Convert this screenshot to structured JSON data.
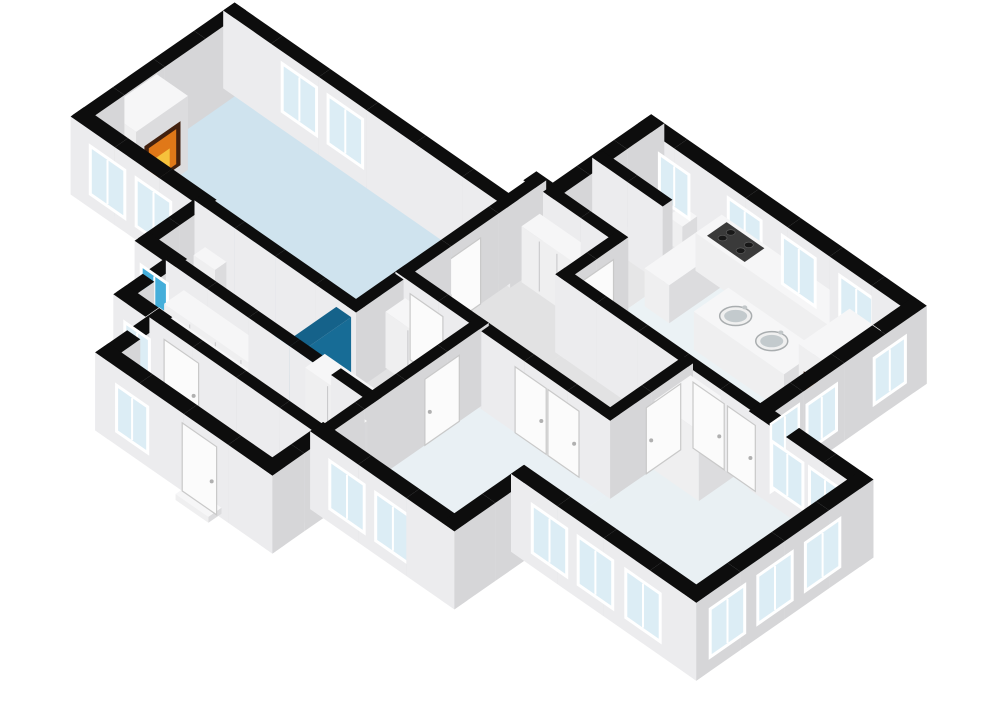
{
  "meta": {
    "view_label": "3d-floorplan-cutaway-render",
    "background": "#ffffff"
  },
  "projection": {
    "ox": 233,
    "oy": 93,
    "ux": 0.82,
    "uy": 0.57,
    "wall_height": 78
  },
  "colors": {
    "cap": "#0d0d0d",
    "faceL": "#ececee",
    "faceR": "#d6d6d8",
    "glass": "#dcedf5",
    "glassBlue": "#45aeda",
    "frame": "#ffffff",
    "doorLeaf": "#fbfbfb",
    "doorEdge": "#c9c9c9",
    "handle": "#b0b0b0",
    "boxTop": "#f6f6f7",
    "boxL": "#efeff0",
    "boxR": "#dcdcde",
    "wardrobeLine": "#c6c6c8",
    "fireDark": "#42210f",
    "fireOrange": "#e07818",
    "fireYellow": "#f6c23c",
    "cooktop": "#3a3a3a",
    "burner": "#181818",
    "burnerRing": "#5c5c5c",
    "stairTop": "#f7f7f7",
    "stairFront": "#e3e3e4",
    "stairSide": "#d8d8da",
    "tubOuter": "#fdfdfd",
    "tubInner": "#edf2f4",
    "tubEdge": "#d5d5d5",
    "metal": "#c2c7c9",
    "sinkRim": "#f0f0f0",
    "sinkBowl": "#c3cacd",
    "sinkEdge": "#a9adaf",
    "showerL": "#2187b7",
    "showerR": "#176c96",
    "showerTop": "#15628a",
    "floorLiving": "#cfe3ee",
    "floorBath": "#2ba3d6",
    "floorHall": "#e2e2e3",
    "floorSmall": "#e6e6e7",
    "floorKitchen": "#ebf2f5",
    "floorBed": "#e9f0f4",
    "floorLounge": "#e9f0f3"
  },
  "floors": [
    {
      "n": "living-room-floor",
      "r": [
        0,
        0,
        330,
        180
      ],
      "fill": "floorLiving"
    },
    {
      "n": "bathroom-floor",
      "r": [
        145,
        180,
        330,
        250
      ],
      "fill": "floorBath"
    },
    {
      "n": "closet-corridor-floor",
      "r": [
        180,
        250,
        420,
        310
      ],
      "fill": "floorHall"
    },
    {
      "n": "entry-hall-floor",
      "r": [
        220,
        310,
        420,
        372
      ],
      "fill": "floorHall"
    },
    {
      "n": "closet-room-floor",
      "r": [
        330,
        120,
        420,
        250
      ],
      "fill": "floorHall"
    },
    {
      "n": "center-hall-floor",
      "r": [
        330,
        -40,
        430,
        120
      ],
      "fill": "floorHall"
    },
    {
      "n": "toilet-room-1-floor",
      "r": [
        350,
        -160,
        430,
        -100
      ],
      "fill": "floorSmall"
    },
    {
      "n": "toilet-room-2-floor",
      "r": [
        350,
        -100,
        430,
        -40
      ],
      "fill": "floorSmall"
    },
    {
      "n": "kitchen-floor",
      "r": [
        430,
        -160,
        670,
        25
      ],
      "fill": "floorKitchen"
    },
    {
      "n": "inner-hall-floor",
      "r": [
        430,
        25,
        580,
        120
      ],
      "fill": "floorHall"
    },
    {
      "n": "bedroom-floor",
      "r": [
        420,
        120,
        580,
        310
      ],
      "fill": "floorBed"
    },
    {
      "n": "living-area-floor",
      "r": [
        580,
        25,
        790,
        225
      ],
      "fill": "floorLounge"
    }
  ],
  "walls": [
    {
      "n": "living-north-wall",
      "r": [
        -10,
        -12,
        340,
        2
      ]
    },
    {
      "n": "living-west-wall",
      "r": [
        -10,
        -12,
        4,
        186
      ]
    },
    {
      "n": "living-southwest-wall",
      "r": [
        -10,
        172,
        152,
        188
      ]
    },
    {
      "n": "bath-west-wall",
      "r": [
        138,
        180,
        152,
        254
      ]
    },
    {
      "n": "bath-south-wall",
      "r": [
        138,
        242,
        186,
        258
      ]
    },
    {
      "n": "corridor-west-wall",
      "r": [
        172,
        250,
        186,
        314
      ]
    },
    {
      "n": "corridor-south-wall",
      "r": [
        172,
        302,
        228,
        318
      ]
    },
    {
      "n": "entry-west-wall",
      "r": [
        212,
        302,
        228,
        380
      ]
    },
    {
      "n": "entry-south-wall",
      "r": [
        212,
        364,
        428,
        380
      ]
    },
    {
      "n": "entry-east-wall",
      "r": [
        412,
        302,
        428,
        380
      ]
    },
    {
      "n": "bedroom-south-wall",
      "r": [
        412,
        302,
        588,
        318
      ]
    },
    {
      "n": "bedroom-east-wall",
      "r": [
        572,
        218,
        588,
        318
      ]
    },
    {
      "n": "lounge-south-wall",
      "r": [
        572,
        217,
        798,
        233
      ]
    },
    {
      "n": "lounge-east-wall",
      "r": [
        782,
        17,
        798,
        233
      ]
    },
    {
      "n": "lounge-north-wall",
      "r": [
        662,
        17,
        798,
        33
      ]
    },
    {
      "n": "kitchen-east-wall",
      "r": [
        662,
        -168,
        678,
        33
      ]
    },
    {
      "n": "kitchen-north-wall",
      "r": [
        422,
        -168,
        678,
        -152
      ]
    },
    {
      "n": "toilet-west-wall",
      "r": [
        342,
        -168,
        358,
        -32
      ]
    },
    {
      "n": "toilet-north-wall",
      "r": [
        342,
        -168,
        430,
        -152
      ]
    },
    {
      "n": "hall-step-wall",
      "r": [
        322,
        -48,
        358,
        -32
      ]
    },
    {
      "n": "living-hall-wall",
      "r": [
        324,
        -46,
        336,
        186
      ]
    },
    {
      "n": "living-bath-wall",
      "r": [
        139,
        174,
        336,
        186
      ]
    },
    {
      "n": "bath-corridor-wall",
      "r": [
        174,
        244,
        426,
        256
      ]
    },
    {
      "n": "corridor-entry-wall",
      "r": [
        214,
        304,
        426,
        316
      ]
    },
    {
      "n": "hall-bedroom-wall",
      "r": [
        324,
        114,
        586,
        126
      ]
    },
    {
      "n": "closet-bedroom-wall",
      "r": [
        414,
        114,
        426,
        316
      ]
    },
    {
      "n": "hall-kitchen-wall",
      "r": [
        424,
        -46,
        436,
        31
      ]
    },
    {
      "n": "kitchen-lounge-wall",
      "r": [
        424,
        19,
        676,
        31
      ]
    },
    {
      "n": "hall-lounge-wall",
      "r": [
        574,
        25,
        586,
        126
      ]
    },
    {
      "n": "toilet-hall-wall",
      "r": [
        344,
        -46,
        436,
        -34
      ]
    },
    {
      "n": "toilet-divider-wall",
      "r": [
        344,
        -106,
        430,
        -94
      ]
    }
  ],
  "openings": [
    {
      "n": "living-north-window-1",
      "k": "win",
      "f": "v",
      "l": 2,
      "r": [
        62,
        104
      ],
      "z": [
        18,
        66
      ]
    },
    {
      "n": "living-north-window-2",
      "k": "win",
      "f": "v",
      "l": 2,
      "r": [
        118,
        160
      ],
      "z": [
        18,
        66
      ]
    },
    {
      "n": "living-sw-window-1",
      "k": "win",
      "f": "v",
      "l": 188,
      "r": [
        14,
        56
      ],
      "z": [
        14,
        62
      ]
    },
    {
      "n": "living-sw-window-2",
      "k": "win",
      "f": "v",
      "l": 188,
      "r": [
        70,
        112
      ],
      "z": [
        14,
        62
      ]
    },
    {
      "n": "bath-window",
      "k": "win",
      "f": "v",
      "l": 258,
      "r": [
        146,
        178
      ],
      "z": [
        14,
        58
      ],
      "g": "glassBlue"
    },
    {
      "n": "corridor-window",
      "k": "win",
      "f": "v",
      "l": 318,
      "r": [
        186,
        216
      ],
      "z": [
        14,
        58
      ]
    },
    {
      "n": "entry-window",
      "k": "win",
      "f": "v",
      "l": 380,
      "r": [
        238,
        276
      ],
      "z": [
        14,
        60
      ]
    },
    {
      "n": "front-door",
      "k": "door",
      "f": "v",
      "l": 380,
      "r": [
        318,
        360
      ],
      "z": [
        0,
        68
      ]
    },
    {
      "n": "bedroom-window-1",
      "k": "win",
      "f": "v",
      "l": 318,
      "r": [
        436,
        478
      ],
      "z": [
        14,
        62
      ]
    },
    {
      "n": "bedroom-window-2",
      "k": "win",
      "f": "v",
      "l": 318,
      "r": [
        492,
        534
      ],
      "z": [
        14,
        62
      ]
    },
    {
      "n": "lounge-south-window-1",
      "k": "win",
      "f": "v",
      "l": 233,
      "r": [
        598,
        640
      ],
      "z": [
        14,
        62
      ]
    },
    {
      "n": "lounge-south-window-2",
      "k": "win",
      "f": "v",
      "l": 233,
      "r": [
        654,
        696
      ],
      "z": [
        14,
        62
      ]
    },
    {
      "n": "lounge-south-window-3",
      "k": "win",
      "f": "v",
      "l": 233,
      "r": [
        712,
        754
      ],
      "z": [
        14,
        62
      ]
    },
    {
      "n": "lounge-east-window-1",
      "k": "win",
      "f": "u",
      "l": 798,
      "r": [
        58,
        100
      ],
      "z": [
        14,
        62
      ]
    },
    {
      "n": "lounge-east-window-2",
      "k": "win",
      "f": "u",
      "l": 798,
      "r": [
        116,
        158
      ],
      "z": [
        14,
        62
      ]
    },
    {
      "n": "lounge-east-window-3",
      "k": "win",
      "f": "u",
      "l": 798,
      "r": [
        174,
        216
      ],
      "z": [
        14,
        62
      ]
    },
    {
      "n": "lounge-north-window-1",
      "k": "win",
      "f": "v",
      "l": 33,
      "r": [
        690,
        728
      ],
      "z": [
        18,
        64
      ]
    },
    {
      "n": "lounge-north-window-2",
      "k": "win",
      "f": "v",
      "l": 33,
      "r": [
        736,
        774
      ],
      "z": [
        18,
        64
      ]
    },
    {
      "n": "kitchen-east-window-1",
      "k": "win",
      "f": "u",
      "l": 678,
      "r": [
        -142,
        -104
      ],
      "z": [
        16,
        62
      ]
    },
    {
      "n": "kitchen-east-window-2",
      "k": "win",
      "f": "u",
      "l": 678,
      "r": [
        -58,
        -22
      ],
      "z": [
        16,
        62
      ]
    },
    {
      "n": "kitchen-glass-door",
      "k": "gdoor",
      "f": "u",
      "l": 678,
      "r": [
        -12,
        22
      ],
      "z": [
        0,
        68
      ]
    },
    {
      "n": "kitchen-north-window-1",
      "k": "win",
      "f": "v",
      "l": -152,
      "r": [
        452,
        492
      ],
      "z": [
        18,
        66
      ]
    },
    {
      "n": "kitchen-north-window-2",
      "k": "win",
      "f": "v",
      "l": -152,
      "r": [
        518,
        558
      ],
      "z": [
        18,
        66
      ]
    },
    {
      "n": "kitchen-north-window-3",
      "k": "win",
      "f": "v",
      "l": -152,
      "r": [
        588,
        628
      ],
      "z": [
        18,
        66
      ]
    },
    {
      "n": "toilet-north-window",
      "k": "win",
      "f": "v",
      "l": -152,
      "r": [
        368,
        404
      ],
      "z": [
        18,
        62
      ]
    },
    {
      "n": "living-hall-door",
      "k": "door",
      "f": "u",
      "l": 336,
      "r": [
        34,
        78
      ],
      "z": [
        0,
        66
      ]
    },
    {
      "n": "corridor-entry-door",
      "k": "door",
      "f": "v",
      "l": 316,
      "r": [
        232,
        274
      ],
      "z": [
        0,
        66
      ]
    },
    {
      "n": "closet-room-door",
      "k": "door",
      "f": "v",
      "l": 126,
      "r": [
        342,
        382
      ],
      "z": [
        0,
        66
      ]
    },
    {
      "n": "bedroom-closet-door-1",
      "k": "door",
      "f": "v",
      "l": 126,
      "r": [
        470,
        508
      ],
      "z": [
        0,
        66
      ]
    },
    {
      "n": "bedroom-closet-door-2",
      "k": "door",
      "f": "v",
      "l": 126,
      "r": [
        510,
        548
      ],
      "z": [
        0,
        66
      ]
    },
    {
      "n": "bedroom-door",
      "k": "door",
      "f": "u",
      "l": 426,
      "r": [
        150,
        192
      ],
      "z": [
        0,
        66
      ]
    },
    {
      "n": "kitchen-door",
      "k": "door",
      "f": "u",
      "l": 436,
      "r": [
        -28,
        14
      ],
      "z": [
        0,
        66
      ]
    },
    {
      "n": "lounge-door-1",
      "k": "door",
      "f": "v",
      "l": 31,
      "r": [
        592,
        630
      ],
      "z": [
        0,
        66
      ]
    },
    {
      "n": "lounge-door-2",
      "k": "door",
      "f": "v",
      "l": 31,
      "r": [
        634,
        668
      ],
      "z": [
        0,
        66
      ]
    },
    {
      "n": "inner-hall-door",
      "k": "door",
      "f": "u",
      "l": 586,
      "r": [
        40,
        82
      ],
      "z": [
        0,
        66
      ]
    },
    {
      "n": "living-fireplace-fire",
      "k": "fire",
      "f": "u",
      "l": 40,
      "r": [
        104,
        148
      ],
      "z": [
        10,
        54
      ]
    },
    {
      "n": "kitchen-fireplace-fire",
      "k": "fire",
      "f": "v",
      "l": -60,
      "r": [
        636,
        662
      ],
      "z": [
        8,
        50
      ]
    }
  ],
  "furniture": [
    {
      "n": "living-fireplace",
      "k": "box",
      "r": [
        2,
        95,
        40,
        158
      ],
      "h": 74
    },
    {
      "n": "kitchen-fireplace",
      "k": "box",
      "r": [
        630,
        -122,
        668,
        -60
      ],
      "h": 74
    },
    {
      "n": "wardrobe-corridor-north",
      "k": "wardrobe",
      "r": [
        192,
        252,
        348,
        276
      ],
      "h": 56,
      "panels": 5
    },
    {
      "n": "wardrobe-corridor-south",
      "k": "wardrobe",
      "r": [
        192,
        282,
        302,
        302
      ],
      "h": 56,
      "panels": 4
    },
    {
      "n": "wardrobe-closet-room-1",
      "k": "wardrobe",
      "r": [
        334,
        124,
        416,
        148
      ],
      "h": 56,
      "panels": 3
    },
    {
      "n": "wardrobe-closet-room-2",
      "k": "wardrobe",
      "r": [
        334,
        222,
        416,
        246
      ],
      "h": 56,
      "panels": 3
    },
    {
      "n": "wardrobe-hall",
      "k": "wardrobe",
      "r": [
        342,
        -32,
        428,
        -10
      ],
      "h": 56,
      "panels": 4
    },
    {
      "n": "toilet-fixture",
      "k": "box",
      "r": [
        396,
        -152,
        414,
        -134
      ],
      "h": 26
    },
    {
      "n": "bath-sink",
      "k": "box",
      "r": [
        148,
        182,
        174,
        196
      ],
      "h": 34
    },
    {
      "n": "shower-wall",
      "k": "box",
      "r": [
        312,
        186,
        330,
        248
      ],
      "h": 70,
      "fl": "showerL",
      "fr": "showerR",
      "ft": "showerTop"
    },
    {
      "n": "kitchen-counter",
      "k": "box",
      "r": [
        438,
        -158,
        648,
        -126
      ],
      "h": 38
    },
    {
      "n": "kitchen-counter-corner",
      "k": "box",
      "r": [
        438,
        -126,
        468,
        -64
      ],
      "h": 38
    },
    {
      "n": "kitchen-island",
      "k": "box",
      "r": [
        506,
        -98,
        616,
        -56
      ],
      "h": 38
    },
    {
      "n": "lounge-cabinet",
      "k": "box",
      "r": [
        588,
        30,
        642,
        74
      ],
      "h": 70
    },
    {
      "n": "front-door-step",
      "k": "box",
      "r": [
        322,
        376,
        362,
        392
      ],
      "h": 6
    },
    {
      "n": "cooktop",
      "k": "cooktop",
      "r": [
        448,
        -154,
        494,
        -130
      ],
      "h": 38,
      "key": 410
    },
    {
      "n": "island-sink-1",
      "k": "sink",
      "c": [
        536,
        -77
      ],
      "h": 38,
      "key": 496
    },
    {
      "n": "island-sink-2",
      "k": "sink",
      "c": [
        580,
        -77
      ],
      "h": 38,
      "key": 500
    },
    {
      "n": "bathtub",
      "k": "tub",
      "c": [
        211,
        214
      ]
    },
    {
      "n": "staircase",
      "k": "stairs",
      "a0": 352,
      "steps": 6,
      "w": 11,
      "b": [
        254,
        308
      ],
      "h0": 10,
      "dh": 9
    }
  ]
}
